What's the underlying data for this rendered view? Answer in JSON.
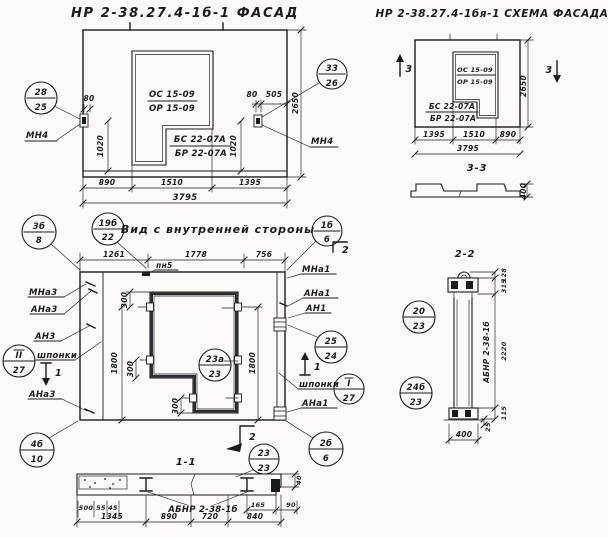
{
  "facade": {
    "title": "НР 2-38.27.4-1б-1 ФАСАД",
    "window_top_a": "ОС 15-09",
    "window_top_b": "ОР 15-09",
    "window_bot_a": "БС 22-07А",
    "window_bot_b": "БР 22-07А",
    "anchor_label": "МН4",
    "callout_left": {
      "top": "28",
      "bottom": "25"
    },
    "callout_right": {
      "top": "33",
      "bottom": "26"
    },
    "dims": {
      "offset": "80",
      "offset_right": "505",
      "anchor_h": "1020",
      "height": "2650",
      "w1": "890",
      "w2": "1510",
      "w3": "1395",
      "total": "3795"
    }
  },
  "scheme": {
    "title": "НР 2-38.27.4-1бя-1 СХЕМА ФАСАДА",
    "window_top_a": "ОС 15-09",
    "window_top_b": "ОР 15-09",
    "window_bot_a": "БС 22-07А",
    "window_bot_b": "БР 22-07А",
    "section_mark": "3",
    "dims": {
      "w1": "1395",
      "w2": "1510",
      "w3": "890",
      "total": "3795",
      "height": "2650"
    },
    "profile": {
      "title": "3-3",
      "thickness": "400"
    }
  },
  "inner": {
    "title": "Вид с внутренней стороны",
    "plate_label": "пн5",
    "keys_label": "шпонки",
    "section_1": "1",
    "section_2": "2",
    "labels": {
      "mna3": "МНа3",
      "ana3": "АНа3",
      "an3": "АН3",
      "mna1": "МНа1",
      "ana1": "АНа1",
      "an1": "АН1"
    },
    "callouts": {
      "tl": {
        "top": "3б",
        "bottom": "8"
      },
      "plate": {
        "top": "19б",
        "bottom": "22"
      },
      "tr": {
        "top": "1б",
        "bottom": "6"
      },
      "mid": {
        "top": "23а",
        "bottom": "23"
      },
      "right": {
        "top": "25",
        "bottom": "24"
      },
      "key_r": {
        "top": "I",
        "bottom": "27"
      },
      "key_l": {
        "top": "II",
        "bottom": "27"
      },
      "bl": {
        "top": "4б",
        "bottom": "10"
      },
      "br": {
        "top": "2б",
        "bottom": "6"
      }
    },
    "dims": {
      "w1": "1261",
      "w2": "1778",
      "w3": "756",
      "s300": "300",
      "v1800": "1800"
    }
  },
  "section11": {
    "title": "1-1",
    "panel_label": "АБНР 2-38-1б",
    "callout": {
      "top": "23",
      "bottom": "23"
    },
    "dims": {
      "a": "500",
      "b": "55",
      "c": "45",
      "w1": "1345",
      "w2": "890",
      "w3": "720",
      "w4": "840",
      "e": "165",
      "f": "90",
      "t": "40"
    }
  },
  "section22": {
    "title": "2-2",
    "panel_label": "АБНР 2-38-1б",
    "callout_top": {
      "top": "20",
      "bottom": "23"
    },
    "callout_bottom": {
      "top": "24б",
      "bottom": "23"
    },
    "dims": {
      "a": "128",
      "b": "315",
      "height": "2220",
      "c": "115",
      "d": "25",
      "width": "400"
    }
  }
}
